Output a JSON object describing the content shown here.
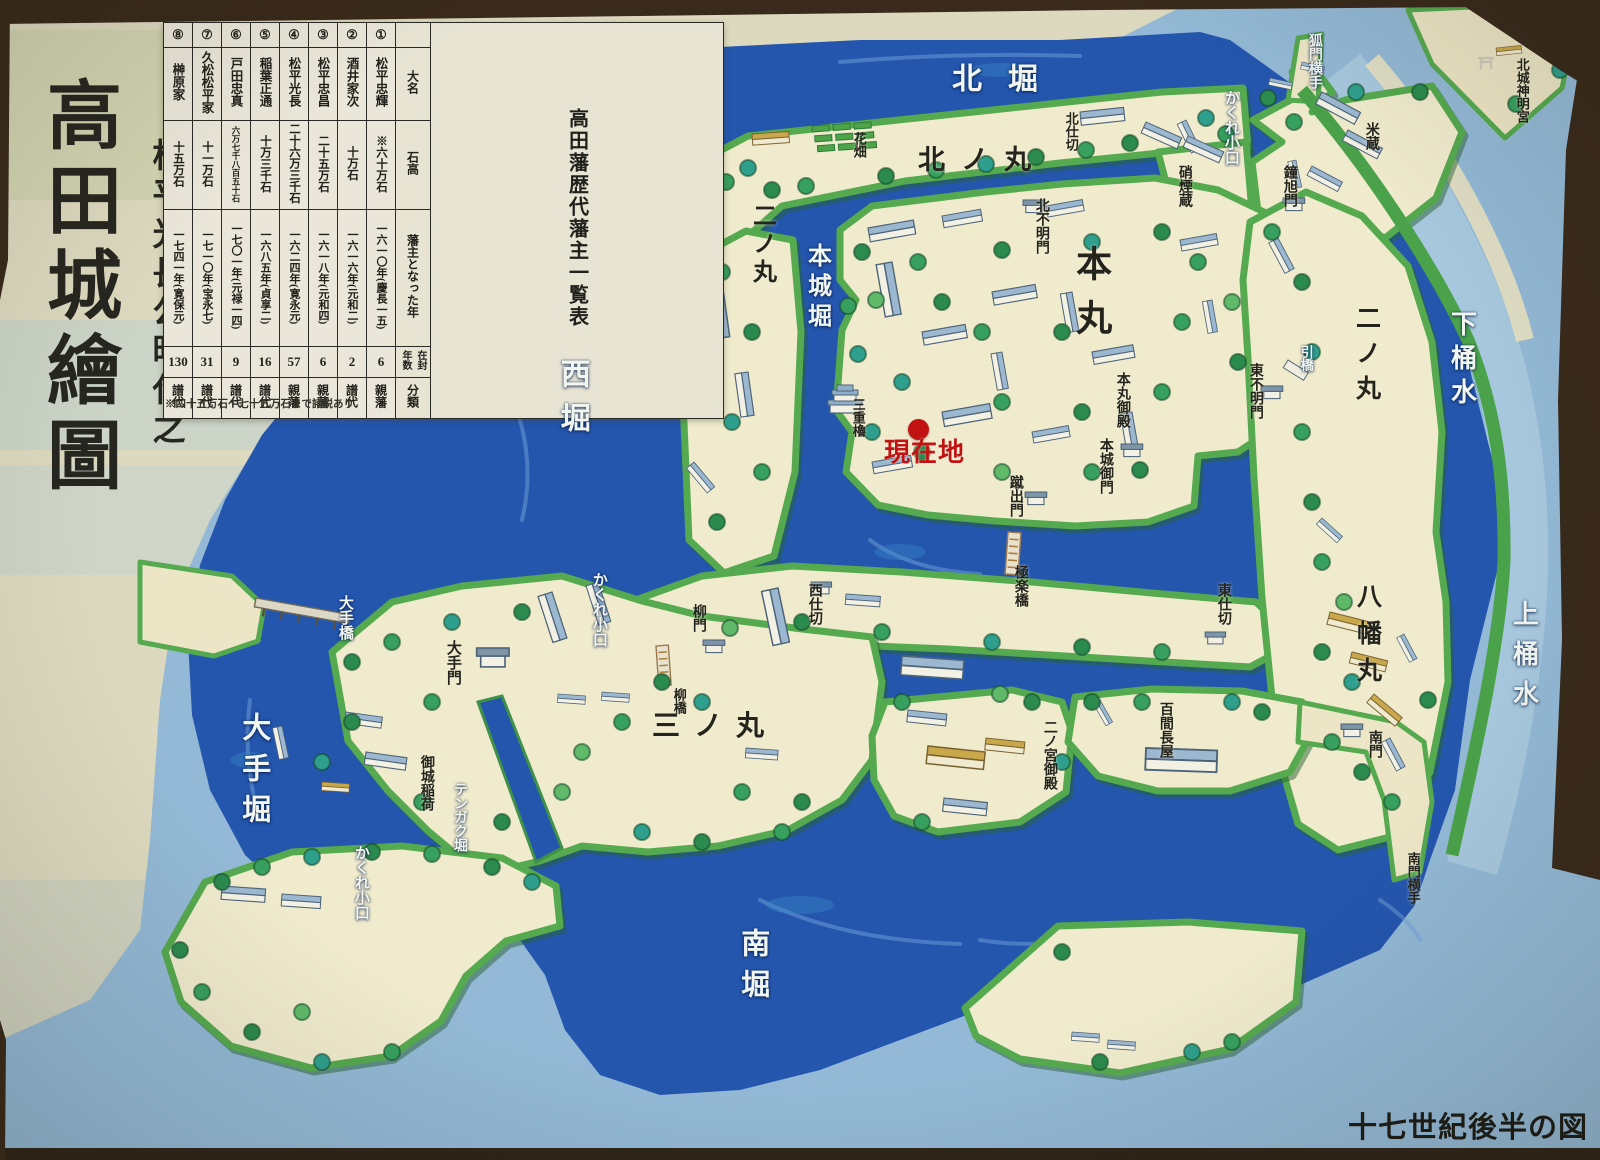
{
  "board": {
    "title_prefix": "松平光長公時代之",
    "title_main": "高田城繪圖",
    "caption": "十七世紀後半の図"
  },
  "marker": {
    "label": "現在地"
  },
  "table": {
    "title": "高田藩歴代藩主一覧表",
    "row_headers": {
      "daimyo": "大名",
      "kokudaka": "石高",
      "year_became_lord": "藩主となった年",
      "tenure_years": "在封年数",
      "category": "分類"
    },
    "footnote": "※四十五万石〜七十五万石まで諸説あり",
    "lords": [
      {
        "num": "①",
        "name": "松平忠輝",
        "koku": "※六十万石",
        "year": "一六一〇年(慶長一五)",
        "tenure": "6",
        "category": "親藩"
      },
      {
        "num": "②",
        "name": "酒井家次",
        "koku": "十万石",
        "year": "一六一六年(元和二)",
        "tenure": "2",
        "category": "譜代"
      },
      {
        "num": "③",
        "name": "松平忠昌",
        "koku": "二十五万石",
        "year": "一六一八年(元和四)",
        "tenure": "6",
        "category": "親藩"
      },
      {
        "num": "④",
        "name": "松平光長",
        "koku": "二十六万三千石",
        "year": "一六二四年(寛永元)",
        "tenure": "57",
        "category": "親藩"
      },
      {
        "num": "⑤",
        "name": "稲葉正通",
        "koku": "十万三千石",
        "year": "一六八五年(貞享二)",
        "tenure": "16",
        "category": "譜代"
      },
      {
        "num": "⑥",
        "name": "戸田忠真",
        "koku": "六万七千八百五十石",
        "year": "一七〇一年(元禄一四)",
        "tenure": "9",
        "category": "譜代"
      },
      {
        "num": "⑦",
        "name": "久松松平家",
        "koku": "十一万石",
        "year": "一七一〇年(宝永七)",
        "tenure": "31",
        "category": "譜代"
      },
      {
        "num": "⑧",
        "name": "榊原家",
        "koku": "十五万石",
        "year": "一七四一年(寛保元)",
        "tenure": "130",
        "category": "譜代"
      }
    ]
  },
  "map": {
    "colors": {
      "moat_dark_blue": "#2456ae",
      "outer_water_light_blue": "#93b9d6",
      "ground_cream": "#f0ebcd",
      "bank_green": "#55a94f",
      "marker_red": "#c21313",
      "frame_brown": "#392a1b"
    },
    "labels": {
      "kita_bori": "北堀",
      "kitanomaru": "北ノ丸",
      "hanabatake": "花畑",
      "kita_shikiri": "北仕切",
      "kakure_north": "かくれ小口",
      "komon_yokote": "狐門横手",
      "shoenkura": "硝煙蔵",
      "kane_mon": "鐘旭門",
      "komekura": "米蔵",
      "kitashiro_shinmeigu": "北城神明宮",
      "ninomaru_west": "二ノ丸",
      "honjo_bori": "本城堀",
      "honmaru": "本丸",
      "kita_akazumon": "北不明門",
      "nishi_bori": "西堀",
      "sanju_yagura": "三重櫓",
      "honmaru_goten": "本丸御殿",
      "higashi_akazumon": "東不明門",
      "honjo_gomon": "本城御門",
      "kedashi_mon": "蹴出門",
      "gokuraku_bashi": "極楽橋",
      "hiki_bashi": "引橋",
      "ninomaru_east": "二ノ丸",
      "shimo_okesui": "下桶水",
      "kami_okesui": "上桶水",
      "hachiman_maru": "八幡丸",
      "nishi_shikiri": "西仕切",
      "higashi_shikiri": "東仕切",
      "yanagi_mon": "柳門",
      "yanagi_bashi": "柳橋",
      "kakure_west": "かくれ小口",
      "ote_bashi": "大手橋",
      "ote_mon": "大手門",
      "ote_bori": "大手堀",
      "sannomaru": "三ノ丸",
      "gojo_inari": "御城稲荷",
      "tengaku_bori": "テンガク堀",
      "kakure_southwest": "かくれ小口",
      "ninomiya_goten": "二ノ宮御殿",
      "hyakken_nagaya": "百間長屋",
      "minami_mon": "南門",
      "minamimon_yokote": "南門横手",
      "minami_bori": "南堀"
    }
  }
}
